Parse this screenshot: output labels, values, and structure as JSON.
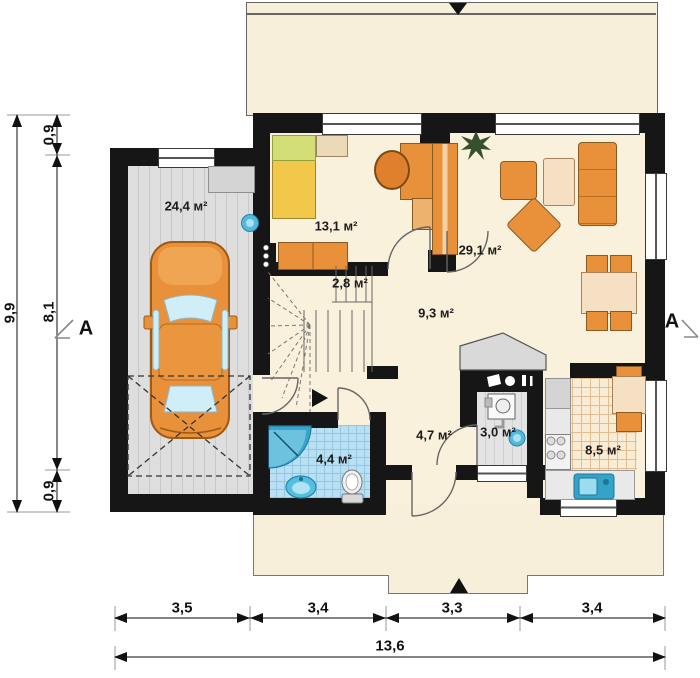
{
  "plan": {
    "rooms": {
      "garage": "24,4 м²",
      "bedroom": "13,1 м²",
      "stairs": "2,8 м²",
      "hall": "9,3 м²",
      "living": "29,1 м²",
      "bathroom": "4,4 м²",
      "corridor": "4,7 м²",
      "utility": "3,0 м²",
      "kitchen": "8,5 м²"
    },
    "dimensions": {
      "left_total": "9,9",
      "left_top": "0,9",
      "left_middle": "8,1",
      "left_bottom": "0,9",
      "bottom_1": "3,5",
      "bottom_2": "3,4",
      "bottom_3": "3,3",
      "bottom_4": "3,4",
      "bottom_total": "13,6"
    },
    "section_marks": {
      "left": "A",
      "right": "A"
    },
    "colors": {
      "wall": "#161616",
      "room_fill": "#faf1dd",
      "terrace_fill": "#f8efda",
      "furniture_orange": "#e8913a",
      "water_blue": "#49b8d8",
      "tile_blue": "#badff0",
      "tile_kitchen": "#f9ecd4"
    }
  }
}
